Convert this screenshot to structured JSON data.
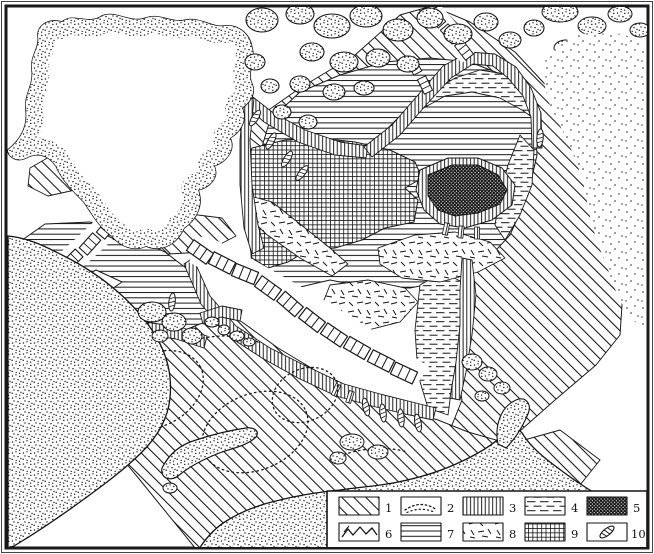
{
  "map": {
    "title": "tectonic-scheme-arctic-ocean",
    "background": "#ffffff",
    "ink": "#141414",
    "frame_color": "#1a1a1a",
    "regions": {
      "shelf_platform": "diagonal-hatch",
      "buried_structure_contours": "dotted-contour",
      "continental_slope_belts": "vertical-lines",
      "basin_margin_zones": "horizontal-dashes",
      "central_massif": "dense-dark-checker",
      "fold_axes": "zigzag-lines",
      "deep_basins": "horizontal-lines",
      "transitional_crust_zones": "random-dashes",
      "amerasian_grid_zone": "grid-crosshatch",
      "ridge_block_chains": "white-block-ladder",
      "volcanic_lenses": "hatched-lens",
      "land_masses": "stippled-white"
    }
  },
  "legend": {
    "items": [
      {
        "num": "1",
        "pattern": "diagonal-hatch"
      },
      {
        "num": "2",
        "pattern": "dotted-contour"
      },
      {
        "num": "3",
        "pattern": "vertical-lines"
      },
      {
        "num": "4",
        "pattern": "horizontal-dashes"
      },
      {
        "num": "5",
        "pattern": "dense-dark-checker"
      },
      {
        "num": "6",
        "pattern": "zigzag-fold-lines"
      },
      {
        "num": "7",
        "pattern": "horizontal-lines"
      },
      {
        "num": "8",
        "pattern": "random-dashes"
      },
      {
        "num": "9",
        "pattern": "grid-crosshatch"
      },
      {
        "num": "10",
        "pattern": "hatched-lens-symbol"
      }
    ]
  }
}
